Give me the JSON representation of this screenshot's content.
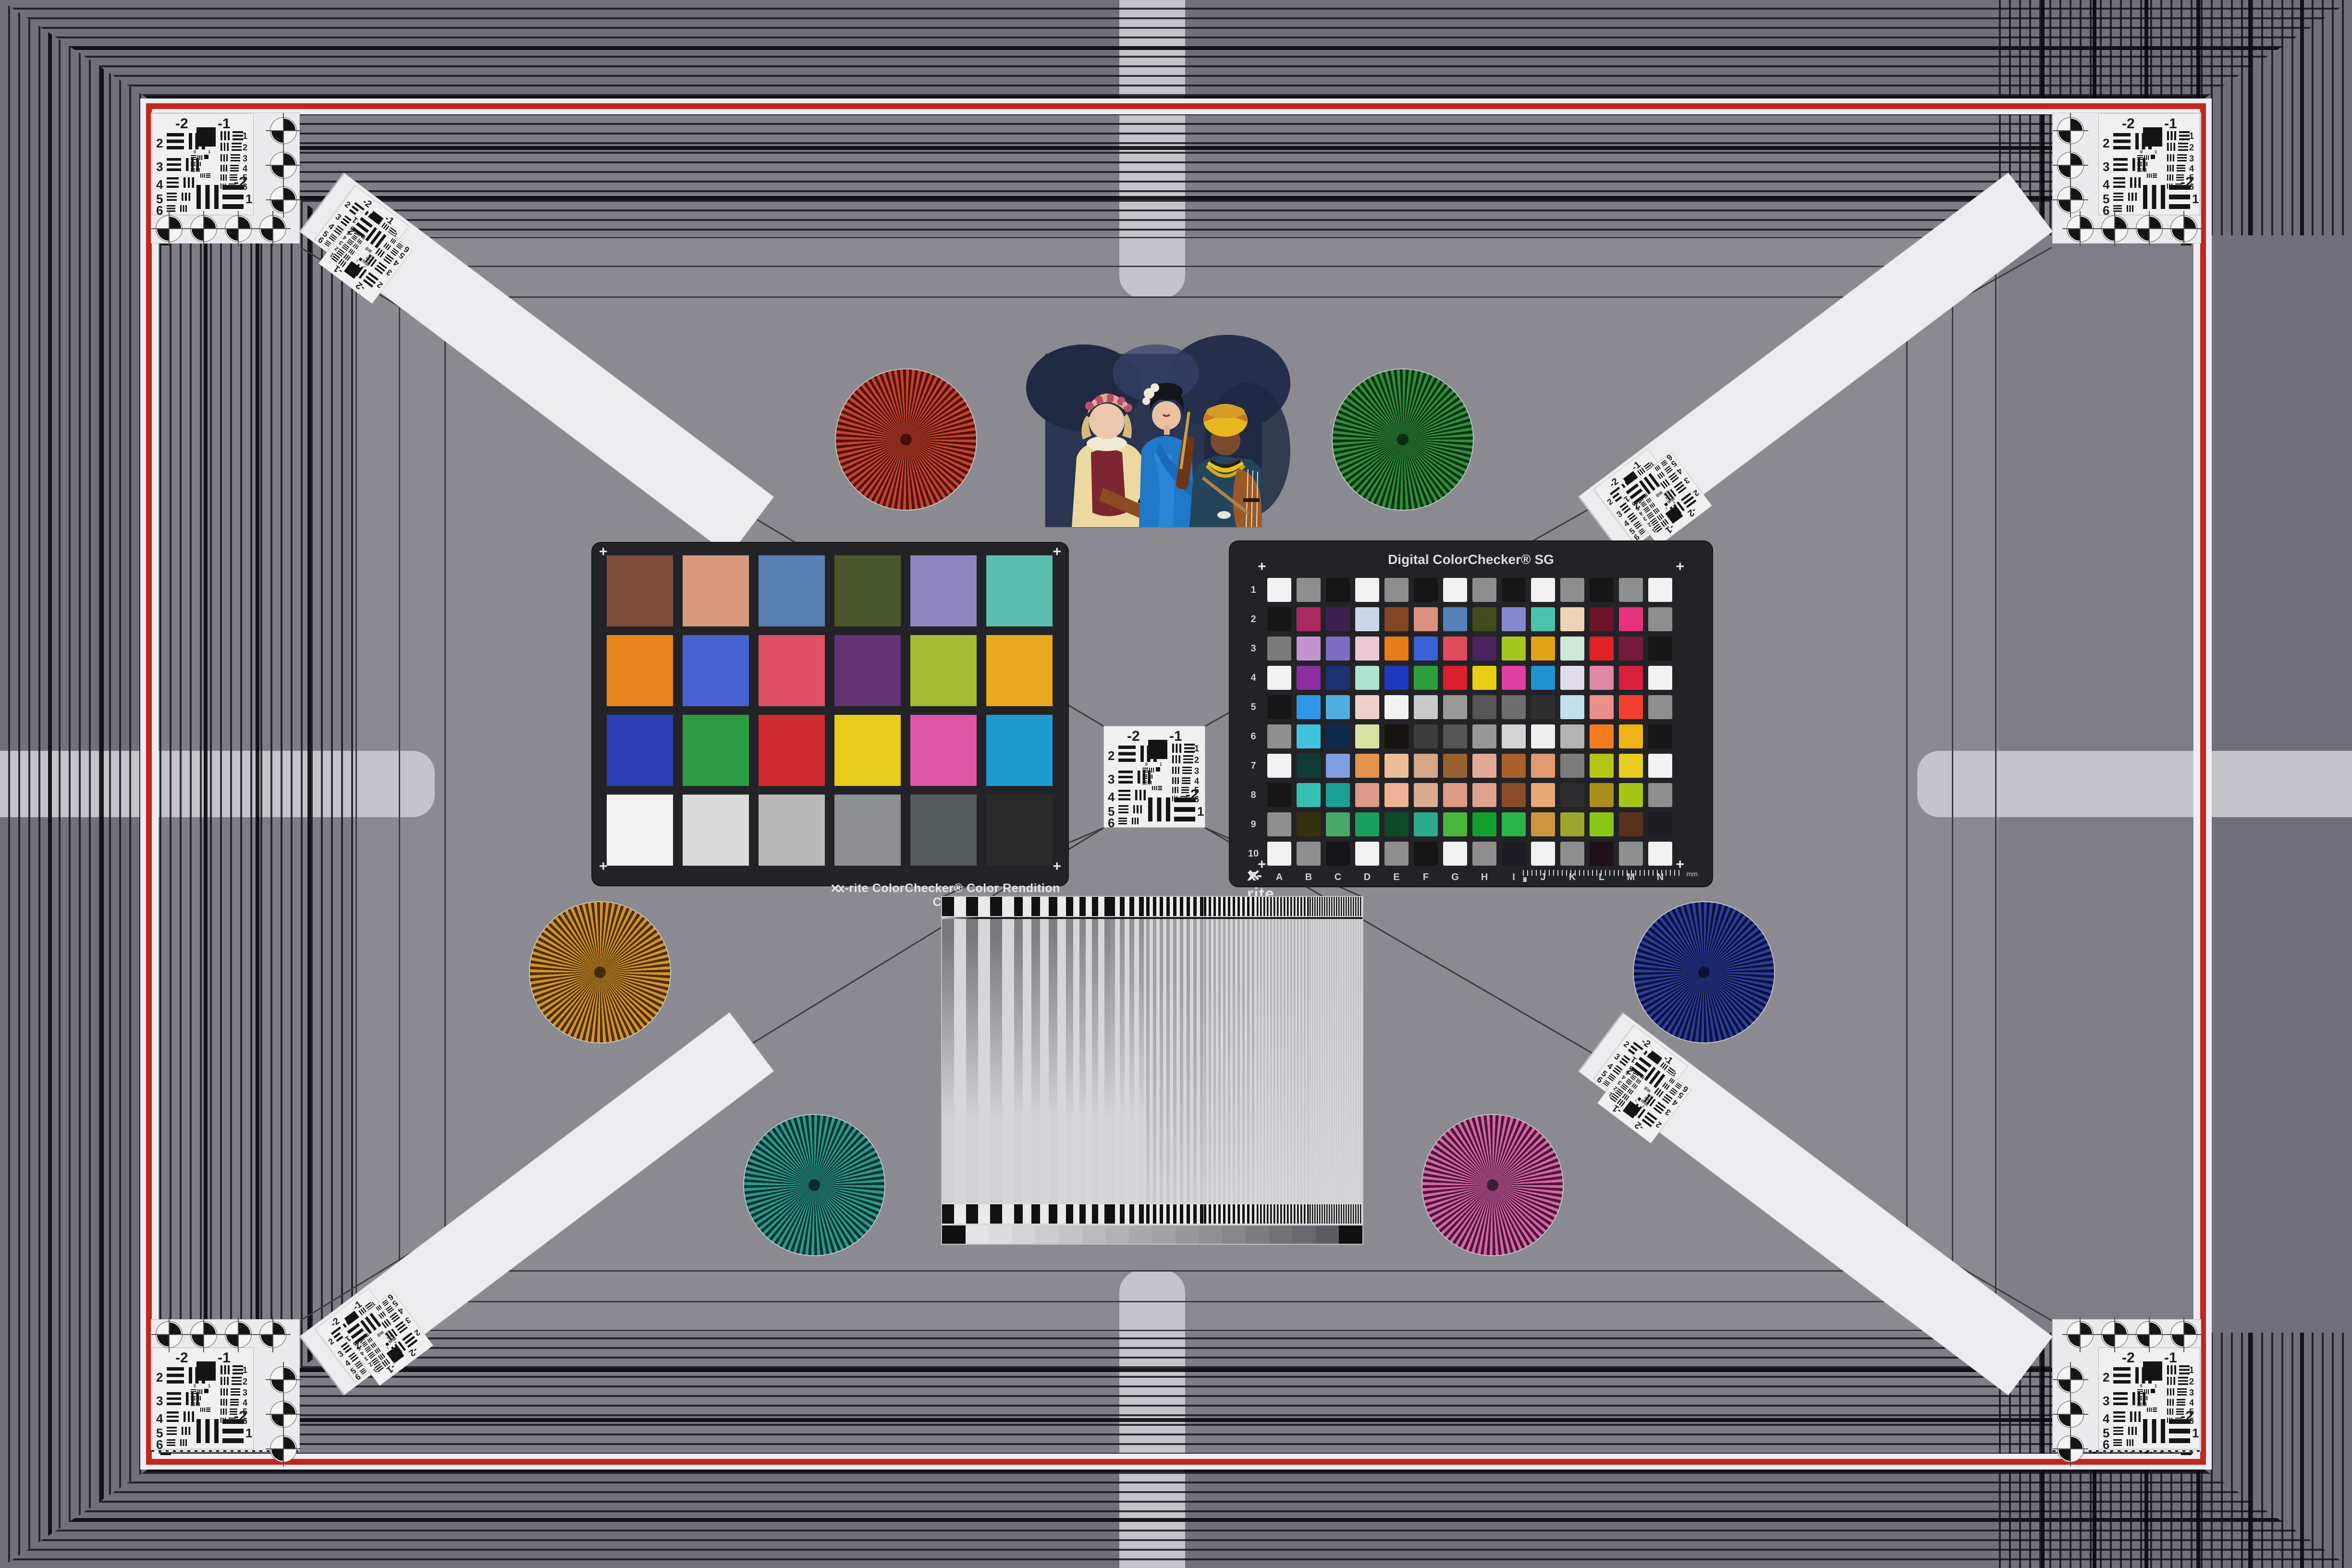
{
  "scene": {
    "name": "camera-test-chart-scene",
    "background": "#8a8a90",
    "frame_red": "#c1271c",
    "frame_band": "#edeef2",
    "tab_color": "#c3c5ca"
  },
  "colorchecker24": {
    "label": "x-rite ColorChecker® Color Rendition Chart",
    "patches": [
      "#7d4b39",
      "#d79a80",
      "#5a7fb2",
      "#49572b",
      "#8b85c0",
      "#58bfaf",
      "#e88620",
      "#4762cf",
      "#dd5065",
      "#623272",
      "#a5bc34",
      "#e8a81e",
      "#2b3fb4",
      "#2e9c45",
      "#cf2a31",
      "#e6cb1d",
      "#dd57a5",
      "#1d9bd0",
      "#f2f2f0",
      "#dadad8",
      "#b7bab9",
      "#8c9090",
      "#555a5a",
      "#2a2b2b"
    ]
  },
  "colorchecker_sg": {
    "title": "Digital ColorChecker® SG",
    "brand": "x-rite",
    "row_labels": [
      "1",
      "2",
      "3",
      "4",
      "5",
      "6",
      "7",
      "8",
      "9",
      "10"
    ],
    "col_labels": [
      "A",
      "B",
      "C",
      "D",
      "E",
      "F",
      "G",
      "H",
      "I",
      "J",
      "K",
      "L",
      "M",
      "N"
    ],
    "ruler_numbers": [
      "0",
      "1",
      "2",
      "3",
      "4",
      "5",
      "6"
    ],
    "ruler_unit": "mm",
    "patches": [
      [
        "#f2f2f2",
        "#8e8e8e",
        "#161616",
        "#f2f2f2",
        "#8e8e8e",
        "#161616",
        "#f2f2f2",
        "#8e8e8e",
        "#161616",
        "#f2f2f2",
        "#8e8e8e",
        "#161616",
        "#8e8e8e",
        "#f2f2f2"
      ],
      [
        "#161616",
        "#ab2860",
        "#3c2150",
        "#ccd6e6",
        "#824624",
        "#dd9180",
        "#5381bc",
        "#3f4c1c",
        "#8787cf",
        "#4cc2ad",
        "#ecd4b4",
        "#6e1428",
        "#e8337c",
        "#8e8e8e"
      ],
      [
        "#7b7b7b",
        "#c293ce",
        "#7d6cc0",
        "#ecc9d2",
        "#e87c15",
        "#3a62d8",
        "#e04a5e",
        "#4c2160",
        "#a6c620",
        "#dfa516",
        "#cfe8d7",
        "#e02227",
        "#77183f",
        "#161616"
      ],
      [
        "#f2f2f2",
        "#8c2da0",
        "#1e3272",
        "#aee2cd",
        "#2038c0",
        "#2e9e3c",
        "#da1f2e",
        "#e8cc16",
        "#df3fa0",
        "#1e93cf",
        "#e0dcea",
        "#e087a6",
        "#da1f3c",
        "#f2f2f2"
      ],
      [
        "#161616",
        "#2e97e8",
        "#51aee2",
        "#eed0cc",
        "#f2f2f2",
        "#c9c9c9",
        "#9a9a9a",
        "#565656",
        "#6e6e6e",
        "#2e2e2e",
        "#c4e0ea",
        "#ea8f8a",
        "#f04030",
        "#8e8e8e"
      ],
      [
        "#8e8e8e",
        "#3ec2dd",
        "#0e2a4a",
        "#d8e2a4",
        "#171212",
        "#3c3c3c",
        "#555555",
        "#979797",
        "#d4d4d4",
        "#eeeeee",
        "#b4b4b4",
        "#f47c20",
        "#f0b418",
        "#161616"
      ],
      [
        "#f2f2f2",
        "#123c36",
        "#7f9ee2",
        "#e2934e",
        "#ecbd96",
        "#d3a788",
        "#9a6030",
        "#e2ab97",
        "#a9612c",
        "#e29a72",
        "#7c7c7c",
        "#b4c414",
        "#e8cc20",
        "#f2f2f2"
      ],
      [
        "#161616",
        "#35c1b2",
        "#1b9e94",
        "#dd9a88",
        "#f0b095",
        "#dcab93",
        "#dc9a85",
        "#dfa28e",
        "#8a4c28",
        "#e8a878",
        "#2e2e30",
        "#ab8f1c",
        "#a6c616",
        "#8e8e8e"
      ],
      [
        "#8e8e8e",
        "#35300f",
        "#47a869",
        "#19a05e",
        "#0c4a2a",
        "#2aaa8a",
        "#49b53b",
        "#12a02c",
        "#2cb449",
        "#cf9440",
        "#9aa62e",
        "#8cc614",
        "#58301c",
        "#1c1c22"
      ],
      [
        "#f2f2f2",
        "#8e8e8e",
        "#15151a",
        "#f2f2f2",
        "#8e8e8e",
        "#161616",
        "#f2f2f2",
        "#8e8e8e",
        "#1c1c22",
        "#f2f2f2",
        "#8e8e8e",
        "#201018",
        "#8e8e8e",
        "#f2f2f2"
      ]
    ]
  },
  "usaf_target": {
    "top_left_label": "-2",
    "top_right_label": "-1",
    "left_numbers": [
      "2",
      "3",
      "4",
      "5",
      "6"
    ],
    "right_numbers": [
      "1",
      "2",
      "3",
      "4",
      "5",
      "6"
    ],
    "bottom_labels": [
      "-2",
      "1"
    ],
    "inner_numbers": [
      "0",
      "1"
    ]
  },
  "starbursts": [
    {
      "name": "red",
      "bright": "#c5432f",
      "dark": "#53120c"
    },
    {
      "name": "green",
      "bright": "#2f8f3e",
      "dark": "#0d3312"
    },
    {
      "name": "orange",
      "bright": "#d3932b",
      "dark": "#4d3008"
    },
    {
      "name": "blue",
      "bright": "#2b3d9e",
      "dark": "#0c1238"
    },
    {
      "name": "teal",
      "bright": "#2a9a8e",
      "dark": "#0b332e"
    },
    {
      "name": "pink",
      "bright": "#d465a8",
      "dark": "#4d1736"
    }
  ],
  "sweep_chart": {
    "segment_widths": [
      150,
      110,
      90,
      75,
      120,
      110,
      110,
      110
    ],
    "segment_periods": [
      50,
      36,
      26,
      20,
      14,
      10,
      7,
      5
    ],
    "segment_opacities": [
      0.55,
      0.5,
      0.45,
      0.4,
      0.32,
      0.26,
      0.2,
      0.15
    ],
    "grayscale_steps": [
      "#101010",
      "#e4e4e6",
      "#dcdcde",
      "#d4d4d6",
      "#ccccce",
      "#c4c4c6",
      "#bbbbbd",
      "#b2b2b4",
      "#aaaaac",
      "#a2a2a4",
      "#99999b",
      "#909092",
      "#87878a",
      "#7d7d80",
      "#727276",
      "#676a6e",
      "#5a5c62",
      "#101010"
    ]
  },
  "photo": {
    "name": "three-musicians-test-photo"
  }
}
